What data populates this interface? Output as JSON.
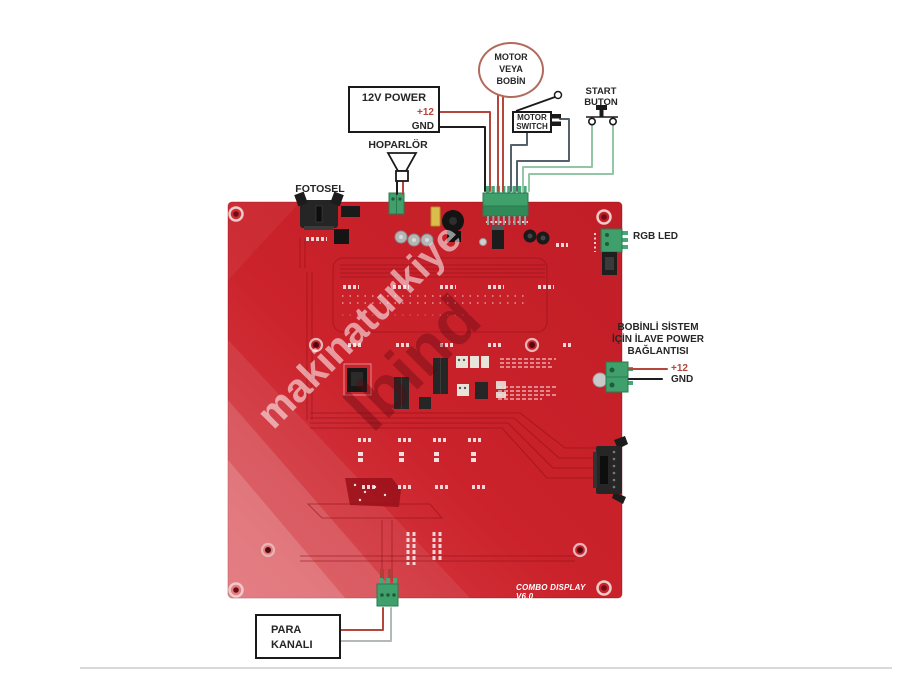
{
  "diagram": {
    "motor": {
      "line1": "MOTOR",
      "line2": "VEYA",
      "line3": "BOBİN"
    },
    "power": {
      "title": "12V POWER",
      "plus": "+12",
      "gnd": "GND"
    },
    "switch": {
      "line1": "MOTOR",
      "line2": "SWITCH"
    },
    "start": {
      "line1": "START",
      "line2": "BUTON"
    },
    "speaker": "HOPARLÖR",
    "photocell": "FOTOSEL",
    "rgb": "RGB LED",
    "aux": {
      "line1": "BOBİNLİ SİSTEM",
      "line2": "İÇİN İLAVE POWER",
      "line3": "BAĞLANTISI",
      "plus": "+12",
      "gnd": "GND"
    },
    "coin": {
      "line1": "PARA",
      "line2": "KANALI"
    }
  },
  "board": {
    "title": "COMBO DISPLAY V6.0"
  },
  "watermarks": {
    "primary": "makinaturkiye",
    "secondary": "lbind"
  },
  "colors": {
    "board_red": "#c92129",
    "wire_red": "#b5463c",
    "wire_black": "#1d1d1d",
    "wire_green": "#92c6a4",
    "wire_gray": "#55616b",
    "terminal_green": "#3fa06c"
  }
}
